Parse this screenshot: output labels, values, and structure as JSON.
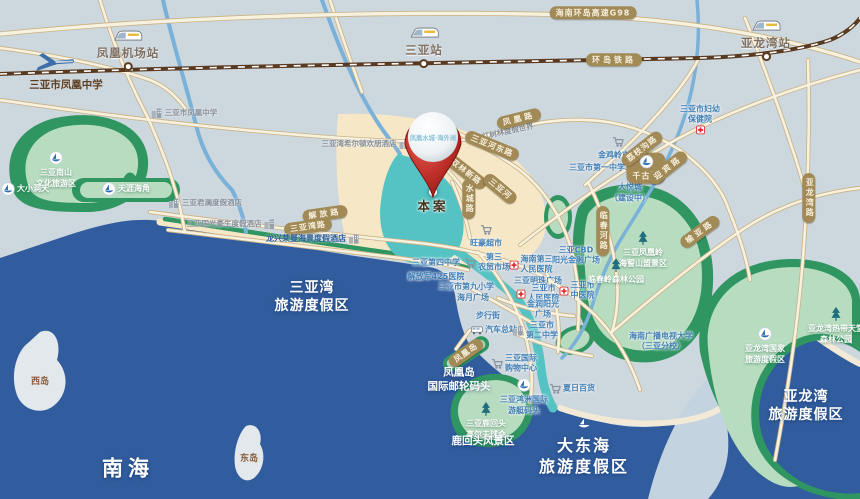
{
  "map": {
    "width": 860,
    "height": 499
  },
  "colors": {
    "sea": "#315c9d",
    "land": "#cdd7de",
    "flats": "#c3d3e0",
    "sand": "#f6e8c6",
    "lagoon_teal": "#55c3c4",
    "green_dark": "#2f9561",
    "green_light": "#b7dcc0",
    "road_fill": "#f7f1df",
    "road_edge": "#c9b184",
    "railway": "#593a20",
    "river": "#79b1d8",
    "badge_bg": "#a28a57",
    "badge_text": "#f6efdc",
    "city_text": "#3f7eb4",
    "pin_red": "#b5261f"
  },
  "pin": {
    "name": "凤凰水城·海外滩",
    "site_label": "本案"
  },
  "labels": [
    {
      "id": "hwy-g98-badge",
      "cls": "badge",
      "x": 593,
      "y": 13,
      "lines": [
        "海南环岛高速G98"
      ]
    },
    {
      "id": "ring-railway-badge",
      "cls": "badge sp",
      "x": 614,
      "y": 60,
      "lines": [
        "环岛铁路"
      ]
    },
    {
      "id": "station-fenghuang-airport",
      "cls": "station",
      "x": 128,
      "y": 50,
      "lines": [
        "凤凰机场站"
      ],
      "icon": "train-icon",
      "ipos": "above"
    },
    {
      "id": "station-sanya",
      "cls": "station",
      "x": 424,
      "y": 47,
      "lines": [
        "三亚站"
      ],
      "icon": "train-icon",
      "ipos": "above"
    },
    {
      "id": "station-yalongwan",
      "cls": "station",
      "x": 766,
      "y": 40,
      "lines": [
        "亚龙湾站"
      ],
      "icon": "train-icon",
      "ipos": "above"
    },
    {
      "id": "airplane",
      "cls": "",
      "x": 54,
      "y": 64,
      "lines": [],
      "icon": "plane-icon",
      "ipos": "above"
    },
    {
      "id": "fenghuang-middle-school-main",
      "cls": "dark",
      "x": 66,
      "y": 86,
      "lines": [
        "三亚市凤凰中学"
      ]
    },
    {
      "id": "fenghuang-middle-school-small",
      "cls": "gray",
      "x": 184,
      "y": 113,
      "lines": [
        "三亚市凤凰中学"
      ],
      "icon": "building-icon",
      "ipos": "left"
    },
    {
      "id": "hilton-hampton-hotel",
      "cls": "gray",
      "x": 366,
      "y": 144,
      "lines": [
        "三亚湾希尔顿欢朋酒店"
      ],
      "icon": "building-icon",
      "ipos": "right"
    },
    {
      "id": "mangrove-resort-world",
      "cls": "gray",
      "x": 502,
      "y": 133,
      "lines": [
        "红树林度假世界"
      ],
      "icon": "resort-icon",
      "ipos": "left",
      "rot": -12
    },
    {
      "id": "fenghuang-road-badge",
      "cls": "badge sp",
      "x": 519,
      "y": 119,
      "lines": [
        "凤凰路"
      ],
      "rot": -14
    },
    {
      "id": "sanyahe-east-road-badge",
      "cls": "badge",
      "x": 492,
      "y": 146,
      "lines": [
        "三亚河东路"
      ],
      "rot": 22
    },
    {
      "id": "jiefang-road-badge",
      "cls": "badge sp",
      "x": 325,
      "y": 214,
      "lines": [
        "解放路"
      ],
      "rot": -8
    },
    {
      "id": "sanya-bay-road-badge",
      "cls": "badge",
      "x": 308,
      "y": 227,
      "lines": [
        "三亚湾路"
      ],
      "rot": -8
    },
    {
      "id": "shuanglin-road-badge",
      "cls": "badge",
      "x": 466,
      "y": 172,
      "lines": [
        "双林新路"
      ],
      "rot": 38
    },
    {
      "id": "shuicheng-road-badge",
      "cls": "badge vert",
      "x": 469,
      "y": 199,
      "lines": [
        "水城路"
      ]
    },
    {
      "id": "sanya-river-badge",
      "cls": "badge",
      "x": 500,
      "y": 189,
      "lines": [
        "三亚河"
      ],
      "rot": 40
    },
    {
      "id": "wanghao-supermarket",
      "cls": "blue",
      "x": 486,
      "y": 237,
      "lines": [
        "旺豪超市"
      ],
      "icon": "cart-icon",
      "ipos": "above"
    },
    {
      "id": "no4-middle-school",
      "cls": "blue",
      "x": 436,
      "y": 263,
      "lines": [
        "三亚第四中学"
      ]
    },
    {
      "id": "no3-farmers-market",
      "cls": "blue",
      "x": 487,
      "y": 263,
      "lines": [
        "第三",
        "农贸市场"
      ],
      "icon": "cart-icon",
      "ipos": "left"
    },
    {
      "id": "hainan-third-peoples-hospital",
      "cls": "blue",
      "x": 531,
      "y": 265,
      "lines": [
        "海南第三",
        "人民医院"
      ],
      "icon": "cross-icon",
      "ipos": "left"
    },
    {
      "id": "pla-425-hospital",
      "cls": "blue",
      "x": 436,
      "y": 277,
      "lines": [
        "解放军425医院"
      ]
    },
    {
      "id": "no9-primary-school",
      "cls": "blue",
      "x": 466,
      "y": 287,
      "lines": [
        "三亚市第九小学"
      ]
    },
    {
      "id": "haiyue-plaza",
      "cls": "blue",
      "x": 473,
      "y": 298,
      "lines": [
        "海月广场"
      ]
    },
    {
      "id": "pedestrian-street",
      "cls": "blue",
      "x": 488,
      "y": 316,
      "lines": [
        "步行街"
      ]
    },
    {
      "id": "bus-terminal",
      "cls": "blue",
      "x": 494,
      "y": 330,
      "lines": [
        "汽车总站"
      ],
      "icon": "bus-icon",
      "ipos": "left"
    },
    {
      "id": "mingzhu-plaza",
      "cls": "blue",
      "x": 538,
      "y": 281,
      "lines": [
        "三亚明珠广场"
      ]
    },
    {
      "id": "sanya-peoples-hospital",
      "cls": "blue",
      "x": 538,
      "y": 294,
      "lines": [
        "三亚市",
        "人民医院"
      ],
      "icon": "cross-icon",
      "ipos": "left"
    },
    {
      "id": "jinrun-sunshine-plaza",
      "cls": "blue",
      "x": 543,
      "y": 310,
      "lines": [
        "金润阳光",
        "广场"
      ]
    },
    {
      "id": "no2-middle-school",
      "cls": "blue",
      "x": 535,
      "y": 331,
      "lines": [
        "三亚市",
        "第二中学"
      ],
      "icon": "building-icon",
      "ipos": "left"
    },
    {
      "id": "sanya-cbd-sunshine-financial-plaza",
      "cls": "blue",
      "x": 576,
      "y": 256,
      "lines": [
        "三亚CBD",
        "阳光金融广场"
      ]
    },
    {
      "id": "sanya-tcm-hospital",
      "cls": "blue",
      "x": 577,
      "y": 291,
      "lines": [
        "三亚市",
        "中医院"
      ],
      "icon": "cross-icon",
      "ipos": "left"
    },
    {
      "id": "maternal-child-health-hospital",
      "cls": "blue",
      "x": 700,
      "y": 121,
      "lines": [
        "三亚市妇幼",
        "保健院"
      ],
      "icon": "cross-icon",
      "ipos": "below"
    },
    {
      "id": "jinjiling-market",
      "cls": "blue",
      "x": 618,
      "y": 149,
      "lines": [
        "金鸡岭市场"
      ],
      "icon": "cart-icon",
      "ipos": "above"
    },
    {
      "id": "no1-middle-school",
      "cls": "blue",
      "x": 597,
      "y": 168,
      "lines": [
        "三亚市第一中学"
      ]
    },
    {
      "id": "joy-city",
      "cls": "blue",
      "x": 630,
      "y": 186,
      "lines": [
        "大悦城",
        "（建设中）"
      ],
      "icon": "cart-icon",
      "ipos": "above"
    },
    {
      "id": "qianguqing-badge",
      "cls": "badge",
      "x": 646,
      "y": 168,
      "lines": [
        "千古情"
      ],
      "icon": "boat-icon",
      "ipos": "above"
    },
    {
      "id": "lizhigou-road-badge",
      "cls": "badge",
      "x": 642,
      "y": 149,
      "lines": [
        "荔枝沟路"
      ],
      "rot": -38
    },
    {
      "id": "yingbin-road-badge",
      "cls": "badge sp",
      "x": 668,
      "y": 168,
      "lines": [
        "迎宾路"
      ],
      "rot": -38
    },
    {
      "id": "yuya-road-badge",
      "cls": "badge sp",
      "x": 700,
      "y": 232,
      "lines": [
        "榆亚路"
      ],
      "rot": -36
    },
    {
      "id": "yalongwan-road-badge",
      "cls": "badge vert",
      "x": 809,
      "y": 198,
      "lines": [
        "亚龙湾路"
      ]
    },
    {
      "id": "linchun-river-road-badge",
      "cls": "badge vert",
      "x": 603,
      "y": 231,
      "lines": [
        "临春河路"
      ]
    },
    {
      "id": "nanshan-cultural-zone",
      "cls": "greenw",
      "x": 56,
      "y": 170,
      "lines": [
        "三亚南山",
        "文化旅游区"
      ],
      "icon": "boat-icon",
      "ipos": "above"
    },
    {
      "id": "daxiaodongtian",
      "cls": "greenw",
      "x": 25,
      "y": 189,
      "lines": [
        "大小洞天"
      ],
      "icon": "boat-icon",
      "ipos": "left"
    },
    {
      "id": "tianya-haijiao",
      "cls": "greenw",
      "x": 126,
      "y": 189,
      "lines": [
        "天涯海角"
      ],
      "icon": "boat-icon",
      "ipos": "left"
    },
    {
      "id": "junlan-resort-hotel",
      "cls": "gray",
      "x": 205,
      "y": 203,
      "lines": [
        "三亚君澜度假酒店"
      ],
      "icon": "building-icon",
      "ipos": "left"
    },
    {
      "id": "guoguang-hotel",
      "cls": "gray",
      "x": 231,
      "y": 224,
      "lines": [
        "三亚国光豪生度假酒店"
      ],
      "icon": "building-icon",
      "ipos": "right"
    },
    {
      "id": "longxing-laiman-hotel",
      "cls": "navy",
      "x": 313,
      "y": 239,
      "lines": [
        "龙兴莱曼海景度假酒店"
      ],
      "icon": "building-icon",
      "ipos": "right"
    },
    {
      "id": "sanya-bay-resort-area",
      "cls": "sea-t md",
      "x": 312,
      "y": 297,
      "lines": [
        "三亚湾",
        "旅游度假区"
      ]
    },
    {
      "id": "west-island",
      "cls": "island",
      "x": 40,
      "y": 383,
      "lines": [
        "西岛"
      ]
    },
    {
      "id": "east-island",
      "cls": "island",
      "x": 249,
      "y": 460,
      "lines": [
        "东岛"
      ]
    },
    {
      "id": "south-china-sea",
      "cls": "sea-t xl",
      "x": 128,
      "y": 469,
      "lines": [
        "南海"
      ]
    },
    {
      "id": "fenghuangling-scenic",
      "cls": "greenw",
      "x": 643,
      "y": 250,
      "lines": [
        "三亚凤凰岭",
        "海誓山盟景区"
      ],
      "icon": "tree-icon",
      "ipos": "above"
    },
    {
      "id": "linchunling-forest-park",
      "cls": "greenw",
      "x": 616,
      "y": 272,
      "lines": [
        "临春岭森林公园"
      ],
      "icon": "tree-icon",
      "ipos": "above"
    },
    {
      "id": "dadonghai-resort-area",
      "cls": "sea-t lg",
      "x": 584,
      "y": 446,
      "lines": [
        "大东海",
        "旅游度假区"
      ],
      "icon": "boat-w-icon",
      "ipos": "above"
    },
    {
      "id": "yalong-tropical-paradise",
      "cls": "greenw",
      "x": 836,
      "y": 326,
      "lines": [
        "亚龙湾热带天堂",
        "森林公园"
      ],
      "icon": "tree-icon",
      "ipos": "above"
    },
    {
      "id": "yalong-national-resort",
      "cls": "greenw",
      "x": 765,
      "y": 346,
      "lines": [
        "亚龙湾国家",
        "旅游度假区"
      ],
      "icon": "boat-icon",
      "ipos": "above"
    },
    {
      "id": "yalongwan-resort-area",
      "cls": "sea-t md",
      "x": 806,
      "y": 406,
      "lines": [
        "亚龙湾",
        "旅游度假区"
      ]
    },
    {
      "id": "phoenix-island-cruise-port",
      "cls": "sea-t sm",
      "x": 459,
      "y": 380,
      "lines": [
        "凤凰岛",
        "国际邮轮码头"
      ]
    },
    {
      "id": "phoenix-island-badge",
      "cls": "badge",
      "x": 466,
      "y": 353,
      "lines": [
        "凤凰岛"
      ],
      "rot": -35
    },
    {
      "id": "intl-shopping-center",
      "cls": "blue",
      "x": 514,
      "y": 364,
      "lines": [
        "三亚国际",
        "购物中心"
      ],
      "icon": "cart-icon",
      "ipos": "left"
    },
    {
      "id": "hongzhou-yacht-marina",
      "cls": "blue",
      "x": 524,
      "y": 397,
      "lines": [
        "三亚鸿洲国际",
        "游艇码头"
      ],
      "icon": "boat-icon",
      "ipos": "above"
    },
    {
      "id": "summer-mall",
      "cls": "blue",
      "x": 572,
      "y": 389,
      "lines": [
        "夏日百货"
      ],
      "icon": "cart-icon",
      "ipos": "left"
    },
    {
      "id": "luhuitou-golf-club",
      "cls": "greenw",
      "x": 486,
      "y": 421,
      "lines": [
        "三亚鹿回头",
        "高尔夫球会"
      ],
      "icon": "tree-icon",
      "ipos": "above"
    },
    {
      "id": "luhuitou-scenic",
      "cls": "sea-t sm",
      "x": 483,
      "y": 442,
      "lines": [
        "鹿回头风景区"
      ]
    },
    {
      "id": "hainan-open-university",
      "cls": "blue",
      "x": 661,
      "y": 342,
      "lines": [
        "海南广播电视大学",
        "（三亚分校）"
      ]
    }
  ]
}
